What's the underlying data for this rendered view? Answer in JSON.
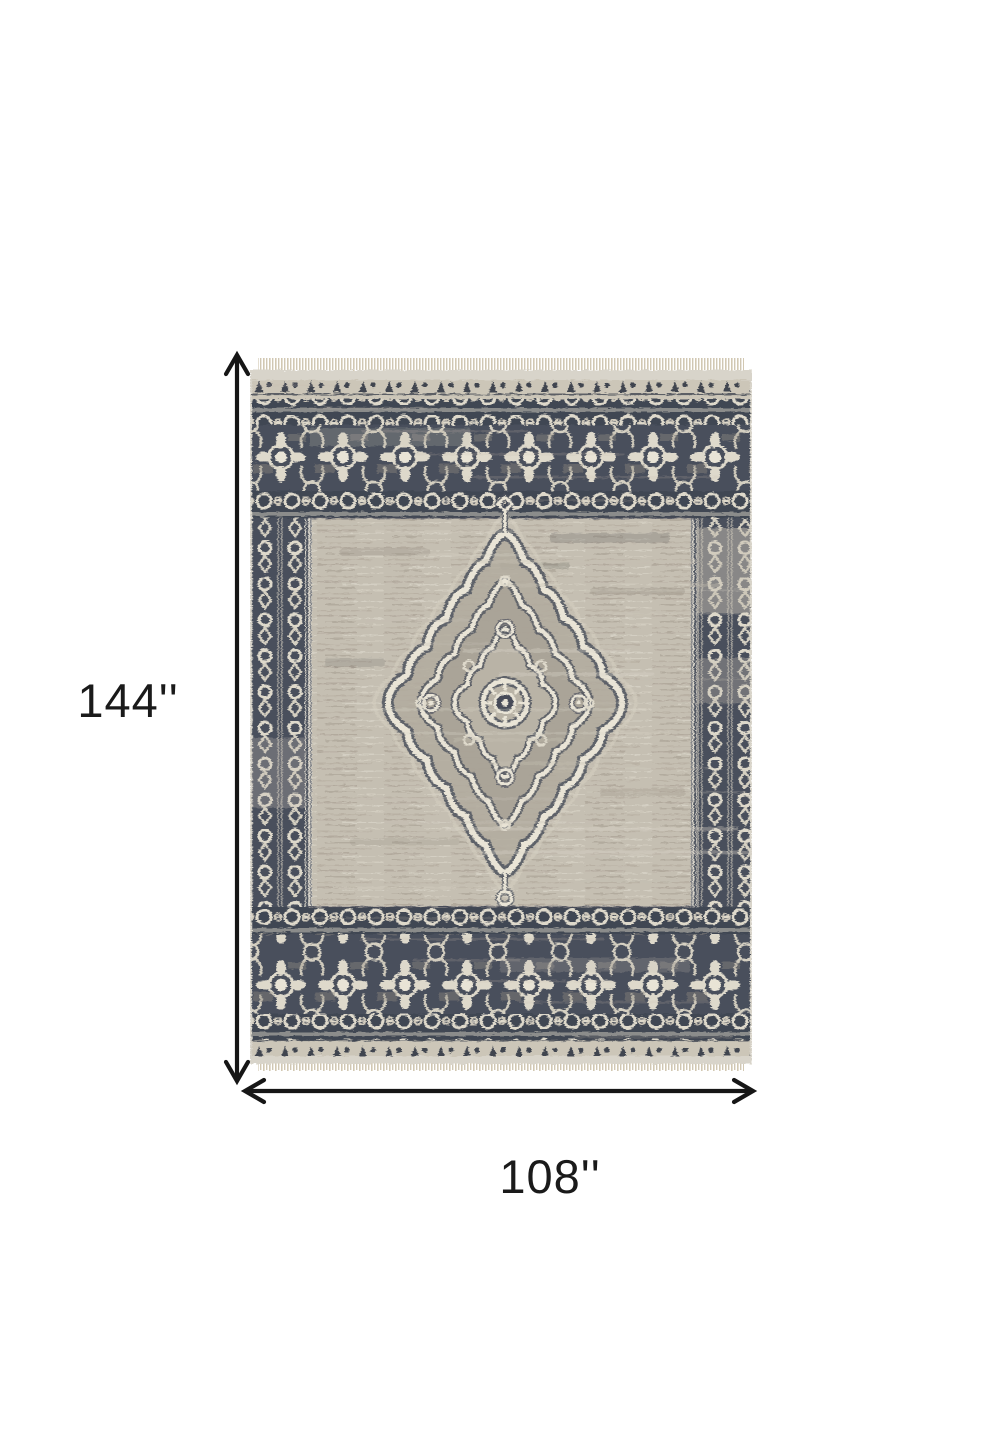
{
  "diagram": {
    "type": "product-dimension-diagram",
    "height_label": "144''",
    "width_label": "108''"
  },
  "rug": {
    "alt": "Distressed gray and charcoal oriental area rug with ivory center medallion, ornate borders and fringe",
    "colors": {
      "page_bg": "#ffffff",
      "arrow": "#161616",
      "label": "#1a1a1a",
      "field": "#c5bfb2",
      "field_light": "#d9d4c8",
      "field_dark": "#9b9386",
      "border_dark": "#414652",
      "border_dark_2": "#4a4f5c",
      "ivory": "#ded9cb",
      "ivory_bright": "#e9e4d6",
      "fringe": "#d2c8b2",
      "edge": "#d8d4ca",
      "medallion_fill": "#b2ac9f",
      "outline_dark": "#4e535e"
    }
  }
}
